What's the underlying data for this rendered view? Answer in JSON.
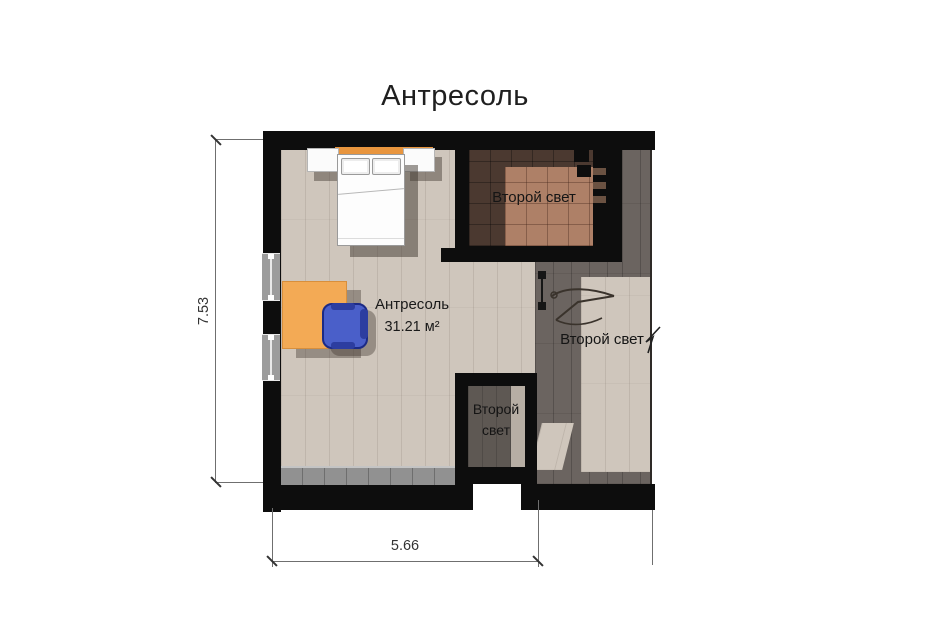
{
  "title": "Антресоль",
  "room": {
    "name": "Антресоль",
    "area": "31.21 м²"
  },
  "labels": {
    "second_light_top": "Второй свет",
    "second_light_right": "Второй свет",
    "second_light_void": "Второй свет"
  },
  "dimensions": {
    "height": "7.53",
    "width": "5.66"
  },
  "palette": {
    "wall": "#0d0d0d",
    "floor-light": "#cfc6bc",
    "floor-dark": "#6b6460",
    "tile-dark": "#4b3930",
    "tile-light": "#ae8067",
    "desk": "#f3aa55",
    "headboard": "#e8953e",
    "chair": "#4a5fc9",
    "chair-dark": "#2c3da0",
    "text": "#222222"
  }
}
